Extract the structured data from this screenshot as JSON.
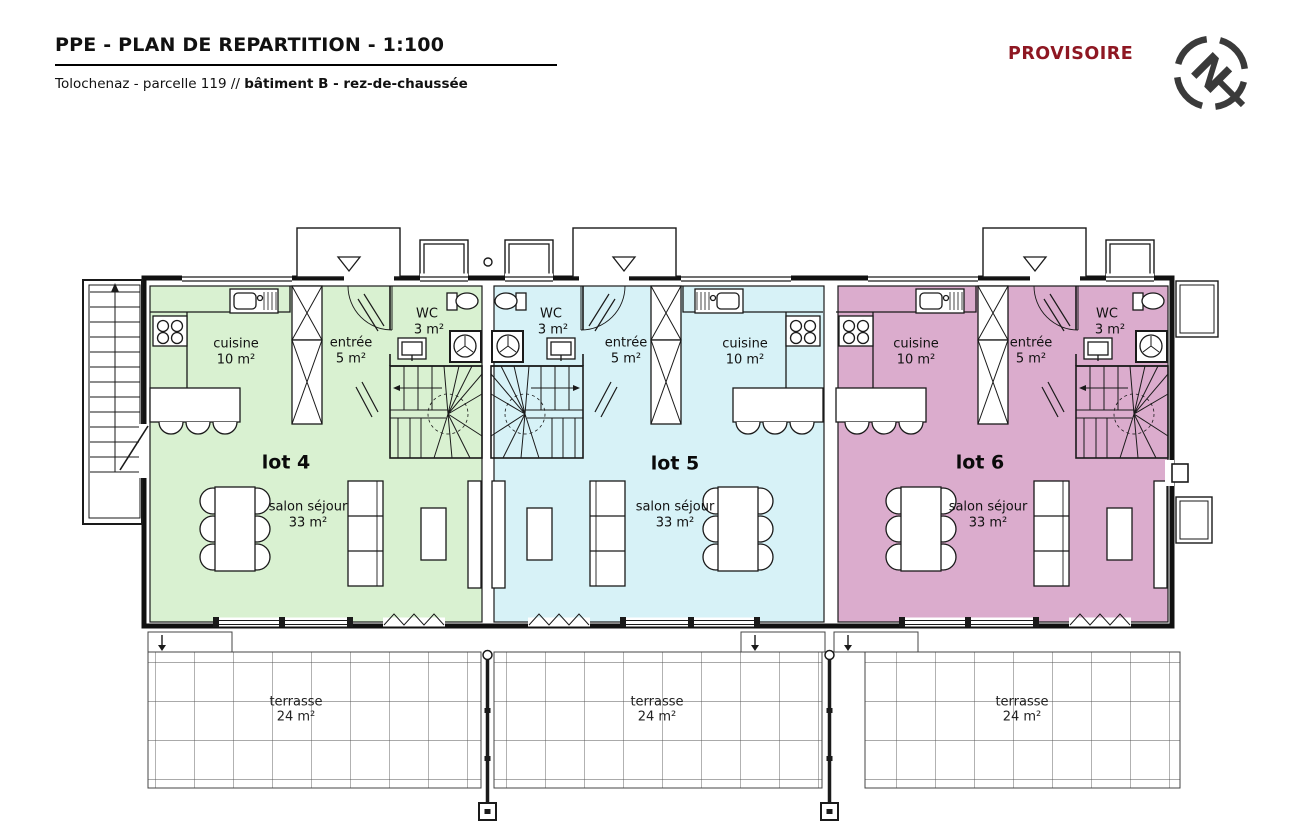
{
  "header": {
    "title": "PPE - PLAN DE REPARTITION - 1:100",
    "subtitle_prefix": "Tolochenaz - parcelle 119 // ",
    "subtitle_bold": "bâtiment B - rez-de-chaussée",
    "status": "PROVISOIRE"
  },
  "compass": {
    "letter": "N"
  },
  "colors": {
    "lot4_fill": "#d9f1d1",
    "lot5_fill": "#d7f2f7",
    "lot6_fill": "#dbaccd",
    "status_text": "#8e1722",
    "line": "#1a1a1a"
  },
  "plan": {
    "lots": [
      {
        "name": "lot 4",
        "rooms": {
          "cuisine": {
            "label": "cuisine",
            "area": "10 m²"
          },
          "entree": {
            "label": "entrée",
            "area": "5 m²"
          },
          "wc": {
            "label": "WC",
            "area": "3 m²"
          },
          "salon": {
            "label": "salon séjour",
            "area": "33 m²"
          },
          "terrasse": {
            "label": "terrasse",
            "area": "24 m²"
          }
        }
      },
      {
        "name": "lot 5",
        "rooms": {
          "cuisine": {
            "label": "cuisine",
            "area": "10 m²"
          },
          "entree": {
            "label": "entrée",
            "area": "5 m²"
          },
          "wc": {
            "label": "WC",
            "area": "3 m²"
          },
          "salon": {
            "label": "salon séjour",
            "area": "33 m²"
          },
          "terrasse": {
            "label": "terrasse",
            "area": "24 m²"
          }
        }
      },
      {
        "name": "lot 6",
        "rooms": {
          "cuisine": {
            "label": "cuisine",
            "area": "10 m²"
          },
          "entree": {
            "label": "entrée",
            "area": "5 m²"
          },
          "wc": {
            "label": "WC",
            "area": "3 m²"
          },
          "salon": {
            "label": "salon séjour",
            "area": "33 m²"
          },
          "terrasse": {
            "label": "terrasse",
            "area": "24 m²"
          }
        }
      }
    ]
  }
}
